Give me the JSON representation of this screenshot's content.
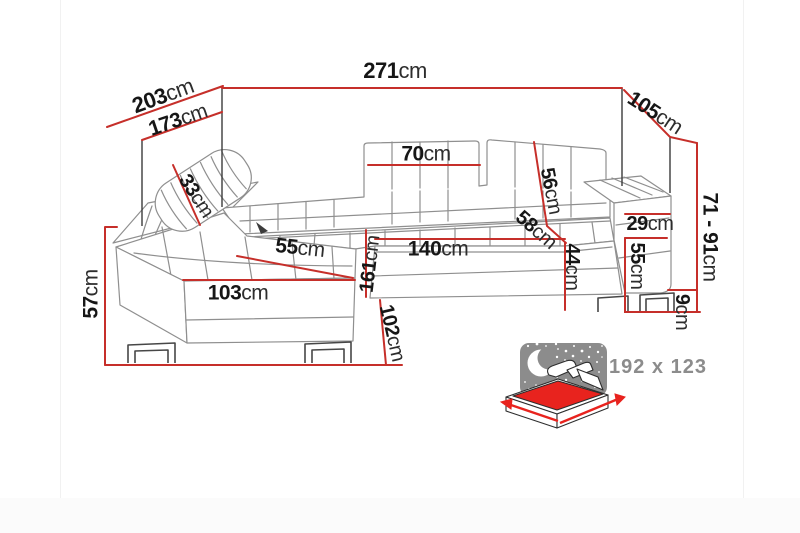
{
  "diagram": {
    "title": "corner-sofa-dimension-diagram",
    "unit_default": "cm",
    "colors": {
      "dimension_line_red": "#c62f2a",
      "label_text_black": "#161616",
      "sofa_outline_gray": "#8f8f8f",
      "icon_night_gray": "#8c8c8c",
      "bed_mattress_red": "#e8231e"
    },
    "dimensions": [
      {
        "id": "total-width-back",
        "value": "271",
        "unit": "cm"
      },
      {
        "id": "chaise-depth-outer",
        "value": "203",
        "unit": "cm"
      },
      {
        "id": "chaise-depth-inner",
        "value": "173",
        "unit": "cm"
      },
      {
        "id": "right-side-depth",
        "value": "105",
        "unit": "cm"
      },
      {
        "id": "height-range",
        "value": "71 - 91",
        "unit": "cm"
      },
      {
        "id": "headrest-pillow",
        "value": "33",
        "unit": "cm"
      },
      {
        "id": "back-cushion-width",
        "value": "70",
        "unit": "cm"
      },
      {
        "id": "backrest-height",
        "value": "56",
        "unit": "cm"
      },
      {
        "id": "seat-depth",
        "value": "58",
        "unit": "cm"
      },
      {
        "id": "armrest-top-width",
        "value": "29",
        "unit": "cm"
      },
      {
        "id": "seat-height",
        "value": "44",
        "unit": "cm"
      },
      {
        "id": "armrest-side-height",
        "value": "55",
        "unit": "cm"
      },
      {
        "id": "seat-front-width",
        "value": "140",
        "unit": "cm"
      },
      {
        "id": "chaise-length",
        "value": "161",
        "unit": "cm"
      },
      {
        "id": "chaise-front-width",
        "value": "103",
        "unit": "cm"
      },
      {
        "id": "chaise-side-height",
        "value": "57",
        "unit": "cm"
      },
      {
        "id": "front-total-length",
        "value": "102",
        "unit": "cm"
      },
      {
        "id": "leg-height",
        "value": "9",
        "unit": "cm"
      },
      {
        "id": "chaise-seat-width",
        "value": "55",
        "unit": "cm"
      }
    ],
    "sleeping_area": {
      "label": "192 x 123"
    }
  }
}
